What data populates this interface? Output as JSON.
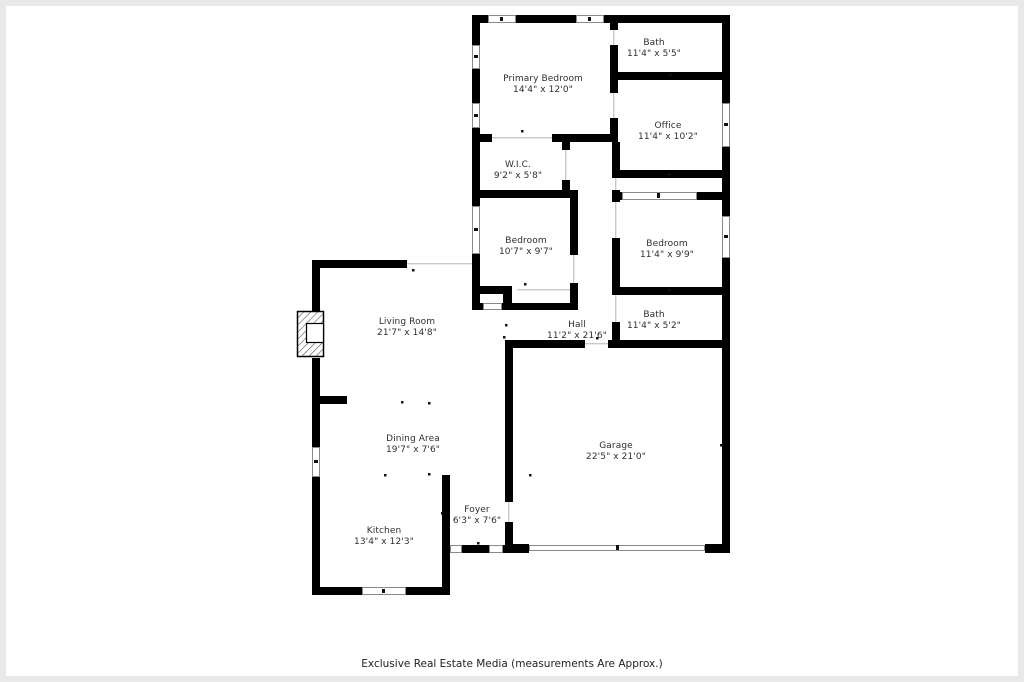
{
  "plan": {
    "title": "Residential floor plan",
    "rooms": [
      {
        "id": "primary-bedroom",
        "name": "Primary Bedroom",
        "dims": "14'4\" x 12'0\""
      },
      {
        "id": "bath-top",
        "name": "Bath",
        "dims": "11'4\" x 5'5\""
      },
      {
        "id": "office",
        "name": "Office",
        "dims": "11'4\" x 10'2\""
      },
      {
        "id": "wic",
        "name": "W.I.C.",
        "dims": "9'2\" x 5'8\""
      },
      {
        "id": "bedroom-left",
        "name": "Bedroom",
        "dims": "10'7\" x 9'7\""
      },
      {
        "id": "bedroom-right",
        "name": "Bedroom",
        "dims": "11'4\" x 9'9\""
      },
      {
        "id": "bath-bottom",
        "name": "Bath",
        "dims": "11'4\" x 5'2\""
      },
      {
        "id": "hall",
        "name": "Hall",
        "dims": "11'2\" x 21'6\""
      },
      {
        "id": "living-room",
        "name": "Living Room",
        "dims": "21'7\" x 14'8\""
      },
      {
        "id": "dining-area",
        "name": "Dining Area",
        "dims": "19'7\" x 7'6\""
      },
      {
        "id": "kitchen",
        "name": "Kitchen",
        "dims": "13'4\" x 12'3\""
      },
      {
        "id": "foyer",
        "name": "Foyer",
        "dims": "6'3\" x 7'6\""
      },
      {
        "id": "garage",
        "name": "Garage",
        "dims": "22'5\" x 21'0\""
      }
    ],
    "footer": "Exclusive Real Estate Media (measurements Are Approx.)",
    "colors": {
      "wall": "#000000",
      "text": "#2e2e2e",
      "background": "#ffffff",
      "frame": "#e9e9e9",
      "window_stroke": "#8a8a8a",
      "opening_line": "#c9c9c9"
    }
  }
}
